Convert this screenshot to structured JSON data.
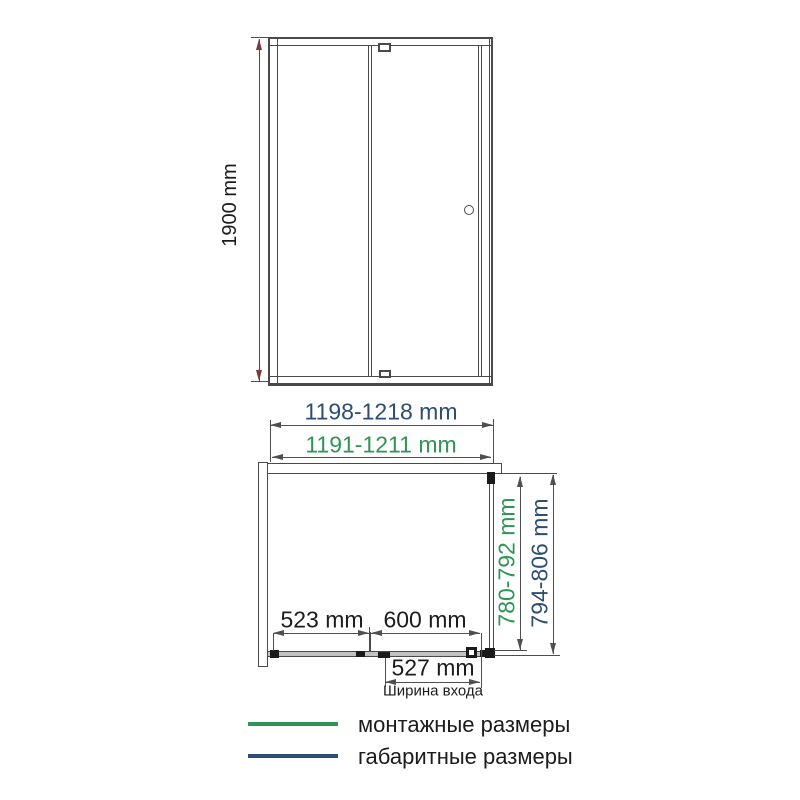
{
  "front_view": {
    "height_label": "1900 mm"
  },
  "width_dimensions": {
    "overall_width_label": "1198-1218 mm",
    "mounting_width_label": "1191-1211 mm"
  },
  "plan_view": {
    "fixed_panel_label": "523 mm",
    "door_panel_label": "600 mm",
    "entry_width_label": "527 mm",
    "entry_width_caption": "Ширина входа",
    "mounting_depth_label": "780-792 mm",
    "overall_depth_label": "794-806 mm"
  },
  "legend": {
    "mounting": {
      "label": "монтажные размеры"
    },
    "overall": {
      "label": "габаритные размеры"
    }
  },
  "colors": {
    "mounting_green": "#2f9455",
    "overall_blue": "#2e4d72",
    "drawing_line": "#4a4a4a",
    "dim_line": "#4f4f4f",
    "arrow_red": "#7c3a38",
    "track_gray": "#c2c2c2"
  }
}
